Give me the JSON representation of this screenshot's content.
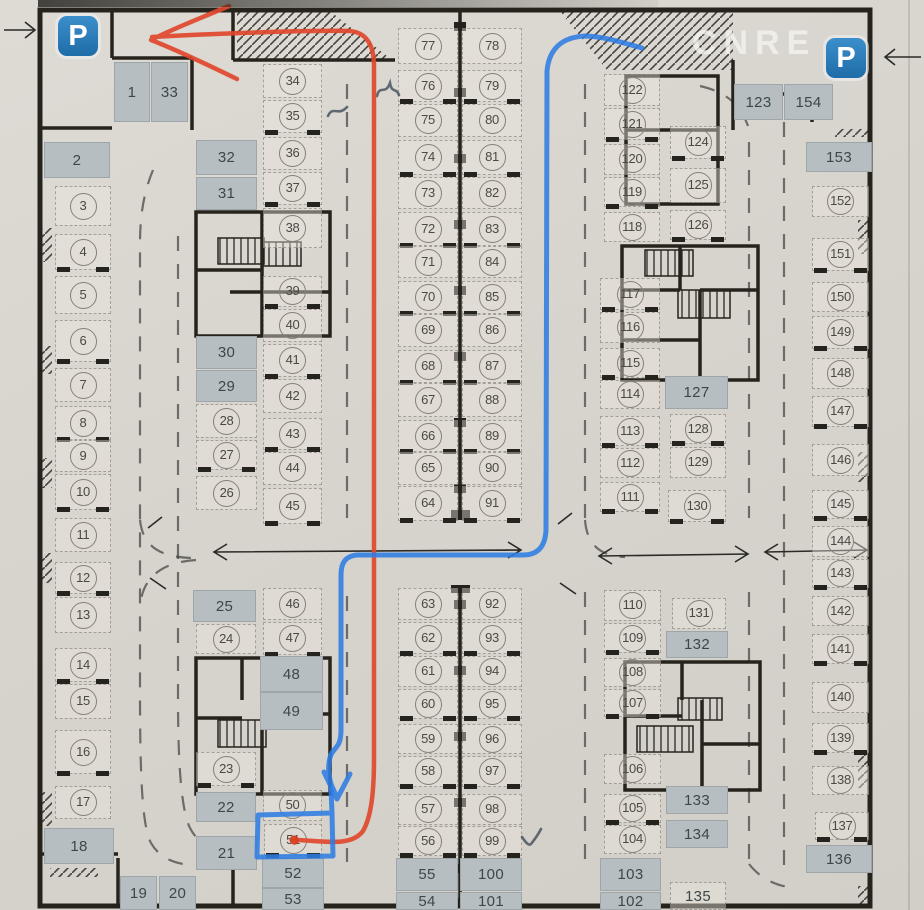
{
  "watermark": "CNRE",
  "signs": {
    "p_left": "P",
    "p_right": "P"
  },
  "highlighted_space": "51",
  "colors": {
    "route_red": "#e0482c",
    "route_blue": "#2f7de2",
    "occupied_cell": "#b6bec2",
    "paper": "#d7d4cd",
    "wall": "#26231d",
    "p_sign": "#2878b8"
  },
  "plan": {
    "spaces": [
      {
        "n": "1",
        "x": 114,
        "y": 62,
        "w": 36,
        "h": 60,
        "f": 1
      },
      {
        "n": "33",
        "x": 151,
        "y": 62,
        "w": 37,
        "h": 60,
        "f": 1
      },
      {
        "n": "2",
        "x": 44,
        "y": 142,
        "w": 66,
        "h": 36,
        "f": 1
      },
      {
        "n": "3",
        "x": 55,
        "y": 186,
        "w": 56,
        "h": 40,
        "f": 0
      },
      {
        "n": "4",
        "x": 55,
        "y": 234,
        "w": 56,
        "h": 36,
        "f": 0
      },
      {
        "n": "5",
        "x": 55,
        "y": 276,
        "w": 56,
        "h": 38,
        "f": 0
      },
      {
        "n": "6",
        "x": 55,
        "y": 320,
        "w": 56,
        "h": 42,
        "f": 0
      },
      {
        "n": "7",
        "x": 55,
        "y": 368,
        "w": 56,
        "h": 34,
        "f": 0
      },
      {
        "n": "8",
        "x": 55,
        "y": 406,
        "w": 56,
        "h": 34,
        "f": 0
      },
      {
        "n": "9",
        "x": 55,
        "y": 440,
        "w": 56,
        "h": 32,
        "f": 0
      },
      {
        "n": "10",
        "x": 55,
        "y": 474,
        "w": 56,
        "h": 36,
        "f": 0
      },
      {
        "n": "11",
        "x": 55,
        "y": 518,
        "w": 56,
        "h": 34,
        "f": 0
      },
      {
        "n": "12",
        "x": 55,
        "y": 562,
        "w": 56,
        "h": 32,
        "f": 0
      },
      {
        "n": "13",
        "x": 55,
        "y": 597,
        "w": 56,
        "h": 36,
        "f": 0
      },
      {
        "n": "14",
        "x": 55,
        "y": 648,
        "w": 56,
        "h": 34,
        "f": 0
      },
      {
        "n": "15",
        "x": 55,
        "y": 684,
        "w": 56,
        "h": 35,
        "f": 0
      },
      {
        "n": "16",
        "x": 55,
        "y": 730,
        "w": 56,
        "h": 44,
        "f": 0
      },
      {
        "n": "17",
        "x": 55,
        "y": 786,
        "w": 56,
        "h": 33,
        "f": 0
      },
      {
        "n": "18",
        "x": 44,
        "y": 828,
        "w": 70,
        "h": 36,
        "f": 1
      },
      {
        "n": "19",
        "x": 120,
        "y": 876,
        "w": 37,
        "h": 34,
        "f": 1
      },
      {
        "n": "20",
        "x": 159,
        "y": 876,
        "w": 37,
        "h": 34,
        "f": 1
      },
      {
        "n": "32",
        "x": 196,
        "y": 140,
        "w": 61,
        "h": 35,
        "f": 1
      },
      {
        "n": "31",
        "x": 196,
        "y": 177,
        "w": 61,
        "h": 33,
        "f": 1
      },
      {
        "n": "30",
        "x": 196,
        "y": 336,
        "w": 61,
        "h": 33,
        "f": 1
      },
      {
        "n": "29",
        "x": 196,
        "y": 370,
        "w": 61,
        "h": 32,
        "f": 1
      },
      {
        "n": "28",
        "x": 196,
        "y": 404,
        "w": 61,
        "h": 34,
        "f": 0
      },
      {
        "n": "27",
        "x": 196,
        "y": 440,
        "w": 61,
        "h": 30,
        "f": 0
      },
      {
        "n": "26",
        "x": 196,
        "y": 476,
        "w": 61,
        "h": 34,
        "f": 0
      },
      {
        "n": "25",
        "x": 193,
        "y": 590,
        "w": 63,
        "h": 32,
        "f": 1
      },
      {
        "n": "24",
        "x": 196,
        "y": 624,
        "w": 60,
        "h": 30,
        "f": 0
      },
      {
        "n": "23",
        "x": 196,
        "y": 752,
        "w": 60,
        "h": 34,
        "f": 0
      },
      {
        "n": "22",
        "x": 196,
        "y": 792,
        "w": 60,
        "h": 30,
        "f": 1
      },
      {
        "n": "21",
        "x": 196,
        "y": 836,
        "w": 61,
        "h": 34,
        "f": 1
      },
      {
        "n": "34",
        "x": 263,
        "y": 64,
        "w": 59,
        "h": 34,
        "f": 0
      },
      {
        "n": "35",
        "x": 263,
        "y": 100,
        "w": 59,
        "h": 33,
        "f": 0
      },
      {
        "n": "36",
        "x": 263,
        "y": 137,
        "w": 59,
        "h": 33,
        "f": 0
      },
      {
        "n": "37",
        "x": 263,
        "y": 172,
        "w": 59,
        "h": 33,
        "f": 0
      },
      {
        "n": "38",
        "x": 263,
        "y": 208,
        "w": 59,
        "h": 40,
        "f": 0
      },
      {
        "n": "39",
        "x": 263,
        "y": 276,
        "w": 59,
        "h": 31,
        "f": 0
      },
      {
        "n": "40",
        "x": 263,
        "y": 309,
        "w": 59,
        "h": 33,
        "f": 0
      },
      {
        "n": "41",
        "x": 263,
        "y": 344,
        "w": 59,
        "h": 33,
        "f": 0
      },
      {
        "n": "42",
        "x": 263,
        "y": 379,
        "w": 59,
        "h": 34,
        "f": 0
      },
      {
        "n": "43",
        "x": 263,
        "y": 418,
        "w": 59,
        "h": 32,
        "f": 0
      },
      {
        "n": "44",
        "x": 263,
        "y": 452,
        "w": 59,
        "h": 33,
        "f": 0
      },
      {
        "n": "45",
        "x": 263,
        "y": 488,
        "w": 59,
        "h": 36,
        "f": 0
      },
      {
        "n": "46",
        "x": 263,
        "y": 588,
        "w": 59,
        "h": 32,
        "f": 0
      },
      {
        "n": "47",
        "x": 263,
        "y": 622,
        "w": 59,
        "h": 33,
        "f": 0
      },
      {
        "n": "48",
        "x": 260,
        "y": 656,
        "w": 63,
        "h": 36,
        "f": 1
      },
      {
        "n": "49",
        "x": 260,
        "y": 692,
        "w": 63,
        "h": 38,
        "f": 1
      },
      {
        "n": "50",
        "x": 263,
        "y": 790,
        "w": 59,
        "h": 31,
        "f": 0
      },
      {
        "n": "51",
        "x": 264,
        "y": 824,
        "w": 58,
        "h": 32,
        "f": 0
      },
      {
        "n": "52",
        "x": 262,
        "y": 858,
        "w": 62,
        "h": 30,
        "f": 1
      },
      {
        "n": "53",
        "x": 262,
        "y": 888,
        "w": 62,
        "h": 22,
        "f": 1
      },
      {
        "n": "77",
        "x": 398,
        "y": 28,
        "w": 60,
        "h": 36,
        "f": 0
      },
      {
        "n": "76",
        "x": 398,
        "y": 70,
        "w": 60,
        "h": 32,
        "f": 0
      },
      {
        "n": "75",
        "x": 398,
        "y": 104,
        "w": 60,
        "h": 33,
        "f": 0
      },
      {
        "n": "74",
        "x": 398,
        "y": 140,
        "w": 60,
        "h": 35,
        "f": 0
      },
      {
        "n": "73",
        "x": 398,
        "y": 177,
        "w": 60,
        "h": 32,
        "f": 0
      },
      {
        "n": "72",
        "x": 398,
        "y": 212,
        "w": 60,
        "h": 34,
        "f": 0
      },
      {
        "n": "71",
        "x": 398,
        "y": 246,
        "w": 60,
        "h": 32,
        "f": 0
      },
      {
        "n": "70",
        "x": 398,
        "y": 281,
        "w": 60,
        "h": 33,
        "f": 0
      },
      {
        "n": "69",
        "x": 398,
        "y": 314,
        "w": 60,
        "h": 33,
        "f": 0
      },
      {
        "n": "68",
        "x": 398,
        "y": 350,
        "w": 60,
        "h": 33,
        "f": 0
      },
      {
        "n": "67",
        "x": 398,
        "y": 383,
        "w": 60,
        "h": 34,
        "f": 0
      },
      {
        "n": "66",
        "x": 398,
        "y": 420,
        "w": 60,
        "h": 32,
        "f": 0
      },
      {
        "n": "65",
        "x": 398,
        "y": 452,
        "w": 60,
        "h": 33,
        "f": 0
      },
      {
        "n": "64",
        "x": 398,
        "y": 486,
        "w": 60,
        "h": 35,
        "f": 0
      },
      {
        "n": "78",
        "x": 462,
        "y": 28,
        "w": 60,
        "h": 36,
        "f": 0
      },
      {
        "n": "79",
        "x": 462,
        "y": 70,
        "w": 60,
        "h": 32,
        "f": 0
      },
      {
        "n": "80",
        "x": 462,
        "y": 104,
        "w": 60,
        "h": 33,
        "f": 0
      },
      {
        "n": "81",
        "x": 462,
        "y": 140,
        "w": 60,
        "h": 35,
        "f": 0
      },
      {
        "n": "82",
        "x": 462,
        "y": 177,
        "w": 60,
        "h": 32,
        "f": 0
      },
      {
        "n": "83",
        "x": 462,
        "y": 212,
        "w": 60,
        "h": 34,
        "f": 0
      },
      {
        "n": "84",
        "x": 462,
        "y": 246,
        "w": 60,
        "h": 32,
        "f": 0
      },
      {
        "n": "85",
        "x": 462,
        "y": 281,
        "w": 60,
        "h": 33,
        "f": 0
      },
      {
        "n": "86",
        "x": 462,
        "y": 314,
        "w": 60,
        "h": 33,
        "f": 0
      },
      {
        "n": "87",
        "x": 462,
        "y": 350,
        "w": 60,
        "h": 33,
        "f": 0
      },
      {
        "n": "88",
        "x": 462,
        "y": 383,
        "w": 60,
        "h": 34,
        "f": 0
      },
      {
        "n": "89",
        "x": 462,
        "y": 420,
        "w": 60,
        "h": 32,
        "f": 0
      },
      {
        "n": "90",
        "x": 462,
        "y": 452,
        "w": 60,
        "h": 33,
        "f": 0
      },
      {
        "n": "91",
        "x": 462,
        "y": 486,
        "w": 60,
        "h": 35,
        "f": 0
      },
      {
        "n": "63",
        "x": 398,
        "y": 588,
        "w": 60,
        "h": 32,
        "f": 0
      },
      {
        "n": "62",
        "x": 398,
        "y": 622,
        "w": 60,
        "h": 32,
        "f": 0
      },
      {
        "n": "61",
        "x": 398,
        "y": 656,
        "w": 60,
        "h": 31,
        "f": 0
      },
      {
        "n": "60",
        "x": 398,
        "y": 689,
        "w": 60,
        "h": 30,
        "f": 0
      },
      {
        "n": "59",
        "x": 398,
        "y": 724,
        "w": 60,
        "h": 30,
        "f": 0
      },
      {
        "n": "58",
        "x": 398,
        "y": 756,
        "w": 60,
        "h": 31,
        "f": 0
      },
      {
        "n": "57",
        "x": 398,
        "y": 794,
        "w": 60,
        "h": 31,
        "f": 0
      },
      {
        "n": "56",
        "x": 398,
        "y": 826,
        "w": 60,
        "h": 30,
        "f": 0
      },
      {
        "n": "55",
        "x": 396,
        "y": 858,
        "w": 62,
        "h": 33,
        "f": 1
      },
      {
        "n": "54",
        "x": 396,
        "y": 892,
        "w": 62,
        "h": 18,
        "f": 1
      },
      {
        "n": "92",
        "x": 462,
        "y": 588,
        "w": 60,
        "h": 32,
        "f": 0
      },
      {
        "n": "93",
        "x": 462,
        "y": 622,
        "w": 60,
        "h": 32,
        "f": 0
      },
      {
        "n": "94",
        "x": 462,
        "y": 656,
        "w": 60,
        "h": 31,
        "f": 0
      },
      {
        "n": "95",
        "x": 462,
        "y": 689,
        "w": 60,
        "h": 30,
        "f": 0
      },
      {
        "n": "96",
        "x": 462,
        "y": 724,
        "w": 60,
        "h": 30,
        "f": 0
      },
      {
        "n": "97",
        "x": 462,
        "y": 756,
        "w": 60,
        "h": 31,
        "f": 0
      },
      {
        "n": "98",
        "x": 462,
        "y": 794,
        "w": 60,
        "h": 31,
        "f": 0
      },
      {
        "n": "99",
        "x": 462,
        "y": 826,
        "w": 60,
        "h": 30,
        "f": 0
      },
      {
        "n": "100",
        "x": 460,
        "y": 858,
        "w": 62,
        "h": 33,
        "f": 1
      },
      {
        "n": "101",
        "x": 460,
        "y": 892,
        "w": 62,
        "h": 18,
        "f": 1
      },
      {
        "n": "122",
        "x": 604,
        "y": 74,
        "w": 56,
        "h": 32,
        "f": 0
      },
      {
        "n": "121",
        "x": 604,
        "y": 108,
        "w": 56,
        "h": 32,
        "f": 0
      },
      {
        "n": "120",
        "x": 604,
        "y": 144,
        "w": 56,
        "h": 31,
        "f": 0
      },
      {
        "n": "119",
        "x": 604,
        "y": 177,
        "w": 56,
        "h": 30,
        "f": 0
      },
      {
        "n": "118",
        "x": 604,
        "y": 212,
        "w": 56,
        "h": 30,
        "f": 0
      },
      {
        "n": "117",
        "x": 600,
        "y": 278,
        "w": 60,
        "h": 32,
        "f": 0
      },
      {
        "n": "116",
        "x": 600,
        "y": 312,
        "w": 60,
        "h": 31,
        "f": 0
      },
      {
        "n": "115",
        "x": 600,
        "y": 348,
        "w": 60,
        "h": 30,
        "f": 0
      },
      {
        "n": "114",
        "x": 600,
        "y": 380,
        "w": 60,
        "h": 29,
        "f": 0
      },
      {
        "n": "113",
        "x": 600,
        "y": 416,
        "w": 60,
        "h": 30,
        "f": 0
      },
      {
        "n": "112",
        "x": 600,
        "y": 448,
        "w": 60,
        "h": 30,
        "f": 0
      },
      {
        "n": "111",
        "x": 600,
        "y": 482,
        "w": 60,
        "h": 30,
        "f": 0
      },
      {
        "n": "110",
        "x": 604,
        "y": 590,
        "w": 57,
        "h": 31,
        "f": 0
      },
      {
        "n": "109",
        "x": 604,
        "y": 623,
        "w": 57,
        "h": 30,
        "f": 0
      },
      {
        "n": "108",
        "x": 604,
        "y": 658,
        "w": 57,
        "h": 29,
        "f": 0
      },
      {
        "n": "107",
        "x": 604,
        "y": 689,
        "w": 57,
        "h": 28,
        "f": 0
      },
      {
        "n": "106",
        "x": 604,
        "y": 754,
        "w": 57,
        "h": 30,
        "f": 0
      },
      {
        "n": "105",
        "x": 604,
        "y": 794,
        "w": 57,
        "h": 29,
        "f": 0
      },
      {
        "n": "104",
        "x": 604,
        "y": 825,
        "w": 57,
        "h": 29,
        "f": 0
      },
      {
        "n": "103",
        "x": 600,
        "y": 858,
        "w": 61,
        "h": 33,
        "f": 1
      },
      {
        "n": "102",
        "x": 600,
        "y": 892,
        "w": 61,
        "h": 18,
        "f": 1
      },
      {
        "n": "124",
        "x": 670,
        "y": 126,
        "w": 56,
        "h": 33,
        "f": 0
      },
      {
        "n": "125",
        "x": 670,
        "y": 168,
        "w": 56,
        "h": 35,
        "f": 0
      },
      {
        "n": "126",
        "x": 670,
        "y": 210,
        "w": 56,
        "h": 30,
        "f": 0
      },
      {
        "n": "127",
        "x": 665,
        "y": 376,
        "w": 63,
        "h": 33,
        "f": 1
      },
      {
        "n": "128",
        "x": 670,
        "y": 414,
        "w": 56,
        "h": 30,
        "f": 0
      },
      {
        "n": "129",
        "x": 670,
        "y": 447,
        "w": 56,
        "h": 31,
        "f": 0
      },
      {
        "n": "130",
        "x": 668,
        "y": 490,
        "w": 58,
        "h": 32,
        "f": 0
      },
      {
        "n": "131",
        "x": 672,
        "y": 598,
        "w": 54,
        "h": 31,
        "f": 0
      },
      {
        "n": "132",
        "x": 666,
        "y": 631,
        "w": 62,
        "h": 27,
        "f": 1
      },
      {
        "n": "133",
        "x": 666,
        "y": 786,
        "w": 62,
        "h": 28,
        "f": 1
      },
      {
        "n": "134",
        "x": 666,
        "y": 820,
        "w": 62,
        "h": 28,
        "f": 1
      },
      {
        "n": "135",
        "x": 670,
        "y": 882,
        "w": 56,
        "h": 28,
        "f": 0,
        "c": 0
      },
      {
        "n": "123",
        "x": 734,
        "y": 84,
        "w": 49,
        "h": 36,
        "f": 1
      },
      {
        "n": "154",
        "x": 784,
        "y": 84,
        "w": 49,
        "h": 36,
        "f": 1
      },
      {
        "n": "153",
        "x": 806,
        "y": 142,
        "w": 66,
        "h": 30,
        "f": 1
      },
      {
        "n": "152",
        "x": 812,
        "y": 186,
        "w": 57,
        "h": 31,
        "f": 0
      },
      {
        "n": "151",
        "x": 812,
        "y": 238,
        "w": 57,
        "h": 33,
        "f": 0
      },
      {
        "n": "150",
        "x": 812,
        "y": 282,
        "w": 57,
        "h": 30,
        "f": 0
      },
      {
        "n": "149",
        "x": 812,
        "y": 316,
        "w": 57,
        "h": 33,
        "f": 0
      },
      {
        "n": "148",
        "x": 812,
        "y": 358,
        "w": 57,
        "h": 31,
        "f": 0
      },
      {
        "n": "147",
        "x": 812,
        "y": 396,
        "w": 57,
        "h": 31,
        "f": 0
      },
      {
        "n": "146",
        "x": 812,
        "y": 444,
        "w": 57,
        "h": 32,
        "f": 0
      },
      {
        "n": "145",
        "x": 812,
        "y": 490,
        "w": 57,
        "h": 29,
        "f": 0
      },
      {
        "n": "144",
        "x": 812,
        "y": 526,
        "w": 57,
        "h": 31,
        "f": 0
      },
      {
        "n": "143",
        "x": 812,
        "y": 559,
        "w": 57,
        "h": 29,
        "f": 0
      },
      {
        "n": "142",
        "x": 812,
        "y": 596,
        "w": 57,
        "h": 30,
        "f": 0
      },
      {
        "n": "141",
        "x": 812,
        "y": 634,
        "w": 57,
        "h": 30,
        "f": 0
      },
      {
        "n": "140",
        "x": 812,
        "y": 682,
        "w": 57,
        "h": 31,
        "f": 0
      },
      {
        "n": "139",
        "x": 812,
        "y": 723,
        "w": 57,
        "h": 30,
        "f": 0
      },
      {
        "n": "138",
        "x": 812,
        "y": 766,
        "w": 57,
        "h": 29,
        "f": 0
      },
      {
        "n": "137",
        "x": 815,
        "y": 812,
        "w": 54,
        "h": 28,
        "f": 0
      },
      {
        "n": "136",
        "x": 806,
        "y": 845,
        "w": 66,
        "h": 28,
        "f": 1
      }
    ]
  },
  "annotations": {
    "red_route": "M237,79 C204,63 172,48 151,40 M229,6 C206,16 172,29 151,40 M152,37 C224,33 320,30 349,31 C367,32 374,46 374,66 L374,758 C374,794 371,817 363,831 C351,847 325,841 297,840",
    "red_dot": "M294,840 L294.5,840.3",
    "blue_route": "M642,48 C621,42 601,36 585,36 C562,37 549,49 547,71 L546,528 C546,545 539,555 523,555 L357,555 C346,556 341,562 341,575 L341,730 C341,752 331,745 329,763 C327,779 333,789 337,797 M324,772 L337,799 L350,774",
    "blue_highlight": "M331,789 L332,813 L258,815 L257,857 L333,856 L332,813",
    "pen_marks": "M328,116 C333,105 338,117 347,107 M377,96 C380,84 385,96 390,83 C392,94 396,87 399,95 M522,837 C526,843 529,846 531,844 C535,839 539,833 541,829"
  }
}
